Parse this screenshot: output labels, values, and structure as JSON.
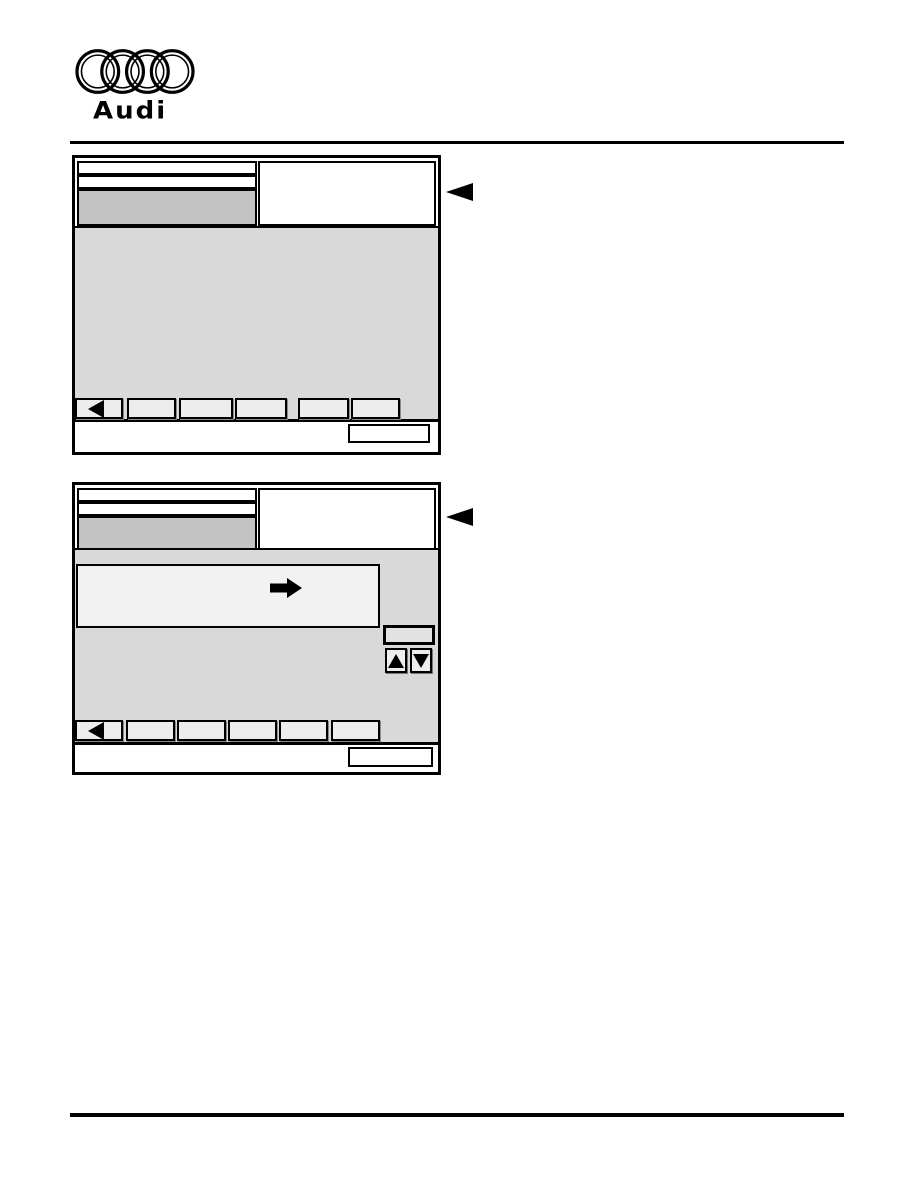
{
  "page": {
    "brand_wordmark": "Audi"
  },
  "colors": {
    "page_bg": "#ffffff",
    "rule": "#000000",
    "screen_bg": "#d9d9d9",
    "header_field_bg": "#c3c3c3",
    "button_bg": "#ededed",
    "panel_bg": "#f2f2f2",
    "icon": "#000000"
  },
  "icons": {
    "brand": "audi-four-rings",
    "callout": "left-pointing-triangle",
    "function_key_back": "left-pointing-triangle",
    "panel_arrow": "right-block-arrow",
    "scroll_up": "up-pointing-triangle",
    "scroll_down": "down-pointing-triangle"
  },
  "screens": [
    {
      "id": "scan-tool-screen-1",
      "header_field_1": "",
      "header_field_2": "",
      "header_field_selected": "",
      "info_panel": "",
      "function_key_labels": [
        "",
        "",
        "",
        "",
        "",
        ""
      ],
      "footer_box": ""
    },
    {
      "id": "scan-tool-screen-2",
      "header_field_1": "",
      "header_field_2": "",
      "header_field_selected": "",
      "info_panel": "",
      "message_panel": "",
      "mini_button": "",
      "function_key_labels": [
        "",
        "",
        "",
        "",
        "",
        ""
      ],
      "footer_box": ""
    }
  ]
}
